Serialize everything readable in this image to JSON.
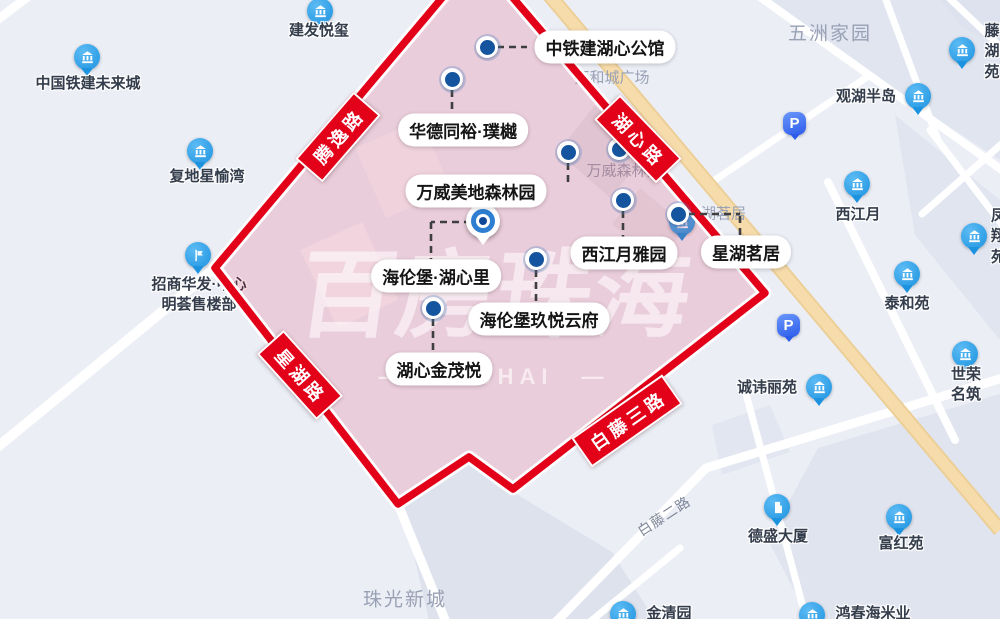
{
  "canvas": {
    "width": 1000,
    "height": 619
  },
  "colors": {
    "map_bg": "#eceef6",
    "block": "#dde2ee",
    "road_white": "#ffffff",
    "road_orange": "#f7dcab",
    "boundary_red": "#e30019",
    "zone_fill": "rgba(231,22,60,0.15)",
    "pin_blue": "#1d93e0",
    "dot_navy": "#15559f",
    "parking_blue": "#2d5ceb"
  },
  "watermark": {
    "text": "百房珠海",
    "subtext": "—　ZHUHAI　—"
  },
  "road_badges": [
    {
      "label": "腾逸路",
      "x": 338,
      "y": 137,
      "rot": -49
    },
    {
      "label": "湖心路",
      "x": 638,
      "y": 139,
      "rot": 46
    },
    {
      "label": "星湖路",
      "x": 300,
      "y": 375,
      "rot": 48
    },
    {
      "label": "白藤三路",
      "x": 627,
      "y": 421,
      "rot": -35
    }
  ],
  "area_labels": [
    {
      "text": "五洲家园",
      "x": 830,
      "y": 32,
      "size": 19
    },
    {
      "text": "珠光新城",
      "x": 405,
      "y": 598,
      "size": 19
    },
    {
      "text": "万和城广场",
      "x": 612,
      "y": 77,
      "size": 15,
      "ls": 0
    },
    {
      "text": "万威森林园",
      "x": 624,
      "y": 170,
      "size": 15,
      "ls": 0
    },
    {
      "text": "星湖茗居",
      "x": 716,
      "y": 213,
      "size": 15,
      "ls": 0
    },
    {
      "text": "白藤二路",
      "x": 664,
      "y": 516,
      "size": 14,
      "rot": -33,
      "color": "#7f8798",
      "ls": 1
    }
  ],
  "pois": [
    {
      "name": "中国铁建未来城",
      "icon": "bank-building-icon",
      "glyph": "bank",
      "px": 87,
      "py": 57,
      "lx": 88,
      "ly": 84
    },
    {
      "name": "建发悦玺",
      "icon": "bank-building-icon",
      "glyph": "bank",
      "px": 320,
      "py": 11,
      "lx": 319,
      "ly": 31
    },
    {
      "name": "复地星愉湾",
      "icon": "bank-building-icon",
      "glyph": "bank",
      "px": 200,
      "py": 151,
      "lx": 207,
      "ly": 177
    },
    {
      "name": "招商华发·中心\n明荟售楼部",
      "icon": "sales-office-icon",
      "glyph": "office",
      "px": 198,
      "py": 255,
      "lx": 199,
      "ly": 295
    },
    {
      "name": "观湖半岛",
      "icon": "bank-building-icon",
      "glyph": "bank",
      "px": 918,
      "py": 96,
      "lx": 866,
      "ly": 97
    },
    {
      "name": "藤湖苑",
      "icon": "bank-building-icon",
      "glyph": "bank",
      "px": 962,
      "py": 50,
      "lx": 984,
      "ly": 52,
      "align": "left"
    },
    {
      "name": "西江月",
      "icon": "bank-building-icon",
      "glyph": "bank",
      "px": 857,
      "py": 184,
      "lx": 858,
      "ly": 215
    },
    {
      "name": "泰和苑",
      "icon": "bank-building-icon",
      "glyph": "bank",
      "px": 907,
      "py": 274,
      "lx": 907,
      "ly": 304
    },
    {
      "name": "凤翔苑",
      "icon": "bank-building-icon",
      "glyph": "bank",
      "px": 974,
      "py": 236,
      "lx": 991,
      "ly": 237,
      "align": "left"
    },
    {
      "name": "世荣名筑",
      "icon": "bank-building-icon",
      "glyph": "bank",
      "px": 965,
      "py": 354,
      "lx": 966,
      "ly": 385
    },
    {
      "name": "诚讳丽苑",
      "icon": "bank-building-icon",
      "glyph": "bank",
      "px": 819,
      "py": 387,
      "lx": 767,
      "ly": 388
    },
    {
      "name": "德盛大厦",
      "icon": "tower-building-icon",
      "glyph": "tower",
      "px": 777,
      "py": 507,
      "lx": 778,
      "ly": 537
    },
    {
      "name": "富红苑",
      "icon": "bank-building-icon",
      "glyph": "bank",
      "px": 899,
      "py": 517,
      "lx": 901,
      "ly": 544
    },
    {
      "name": "金清园",
      "icon": "bank-building-icon",
      "glyph": "bank",
      "px": 623,
      "py": 614,
      "lx": 669,
      "ly": 614
    },
    {
      "name": "鸿春海米业",
      "icon": "bank-building-icon",
      "glyph": "bank",
      "px": 812,
      "py": 615,
      "lx": 873,
      "ly": 614
    },
    {
      "name": "",
      "icon": "bank-building-icon",
      "glyph": "bank",
      "px": 682,
      "py": 222,
      "lx": 0,
      "ly": 0
    }
  ],
  "parking": {
    "label": "P",
    "spots": [
      {
        "x": 795,
        "y": 124
      },
      {
        "x": 789,
        "y": 326
      }
    ]
  },
  "estates": [
    {
      "name": "中铁建湖心公馆",
      "x": 605,
      "y": 47
    },
    {
      "name": "华德同裕·璞樾",
      "x": 463,
      "y": 130
    },
    {
      "name": "万威美地森林园",
      "x": 476,
      "y": 191
    },
    {
      "name": "西江月雅园",
      "x": 624,
      "y": 253
    },
    {
      "name": "星湖茗居",
      "x": 746,
      "y": 252
    },
    {
      "name": "海伦堡·湖心里",
      "x": 436,
      "y": 276
    },
    {
      "name": "海伦堡玖悦云府",
      "x": 539,
      "y": 319
    },
    {
      "name": "湖心金茂悦",
      "x": 439,
      "y": 369
    }
  ],
  "dots": [
    {
      "x": 487,
      "y": 47
    },
    {
      "x": 452,
      "y": 79
    },
    {
      "x": 568,
      "y": 152
    },
    {
      "x": 623,
      "y": 200
    },
    {
      "x": 678,
      "y": 214
    },
    {
      "x": 536,
      "y": 259
    },
    {
      "x": 433,
      "y": 308
    }
  ],
  "hidden_dot": {
    "x": 619,
    "y": 149
  },
  "target_marker": {
    "x": 483,
    "y": 222
  }
}
